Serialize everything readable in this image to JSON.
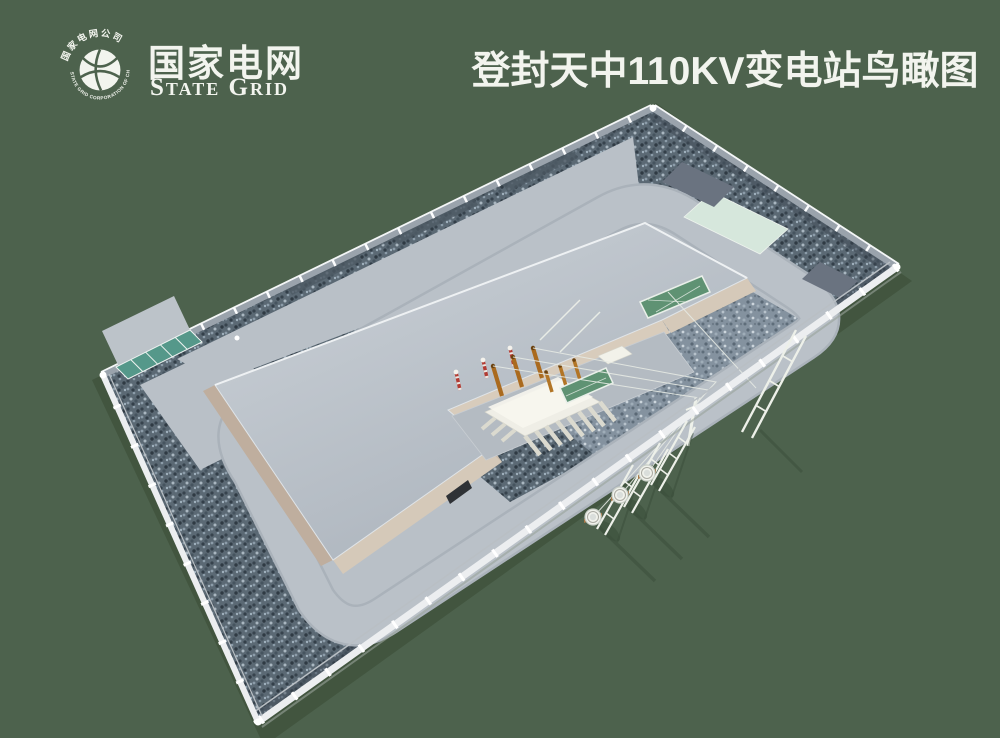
{
  "header": {
    "logo": {
      "emblem_ring_top": "国家电网公司",
      "emblem_ring_bottom": "STATE GRID CORPORATION OF CHINA",
      "name_cn": "国家电网",
      "name_en": "State Grid"
    },
    "title": "登封天中110KV变电站鸟瞰图"
  },
  "scene": {
    "type": "3d-architectural-rendering",
    "subject": "Bird's-eye view of a 110KV substation compound",
    "elements": [
      "perimeter-fence",
      "perimeter-wall",
      "entrance-gate",
      "gate-apron",
      "ring-road",
      "main-building",
      "transformer-bay",
      "main-transformer",
      "transformer-bushings",
      "surge-arresters",
      "green-mesh-screens",
      "terminal-poles",
      "gantry-frames",
      "overhead-wires",
      "gravel-yard",
      "mint-equipment-pad",
      "dark-equipment-pads",
      "cable-trench-covers"
    ],
    "palette": {
      "background": "#4d624d",
      "shadow": "#42553f",
      "gravel_dark": "#5b6974",
      "gravel_light": "#84929f",
      "pavement": "#bac1c8",
      "roof": "#c3cad1",
      "wall_tan": "#d5c9b9",
      "fence_white": "#eceef0",
      "fence_mesh": "#9aa3ac",
      "gate_teal": "#55988a",
      "pad_mint": "#d6e7dc",
      "pad_dark": "#6a7380",
      "transformer_cream": "#efeee6",
      "bushing_orange": "#aa6a1e",
      "arrester_red": "#b23b33",
      "screen_green": "#5f9273",
      "text_white": "#f2f4ee"
    }
  }
}
